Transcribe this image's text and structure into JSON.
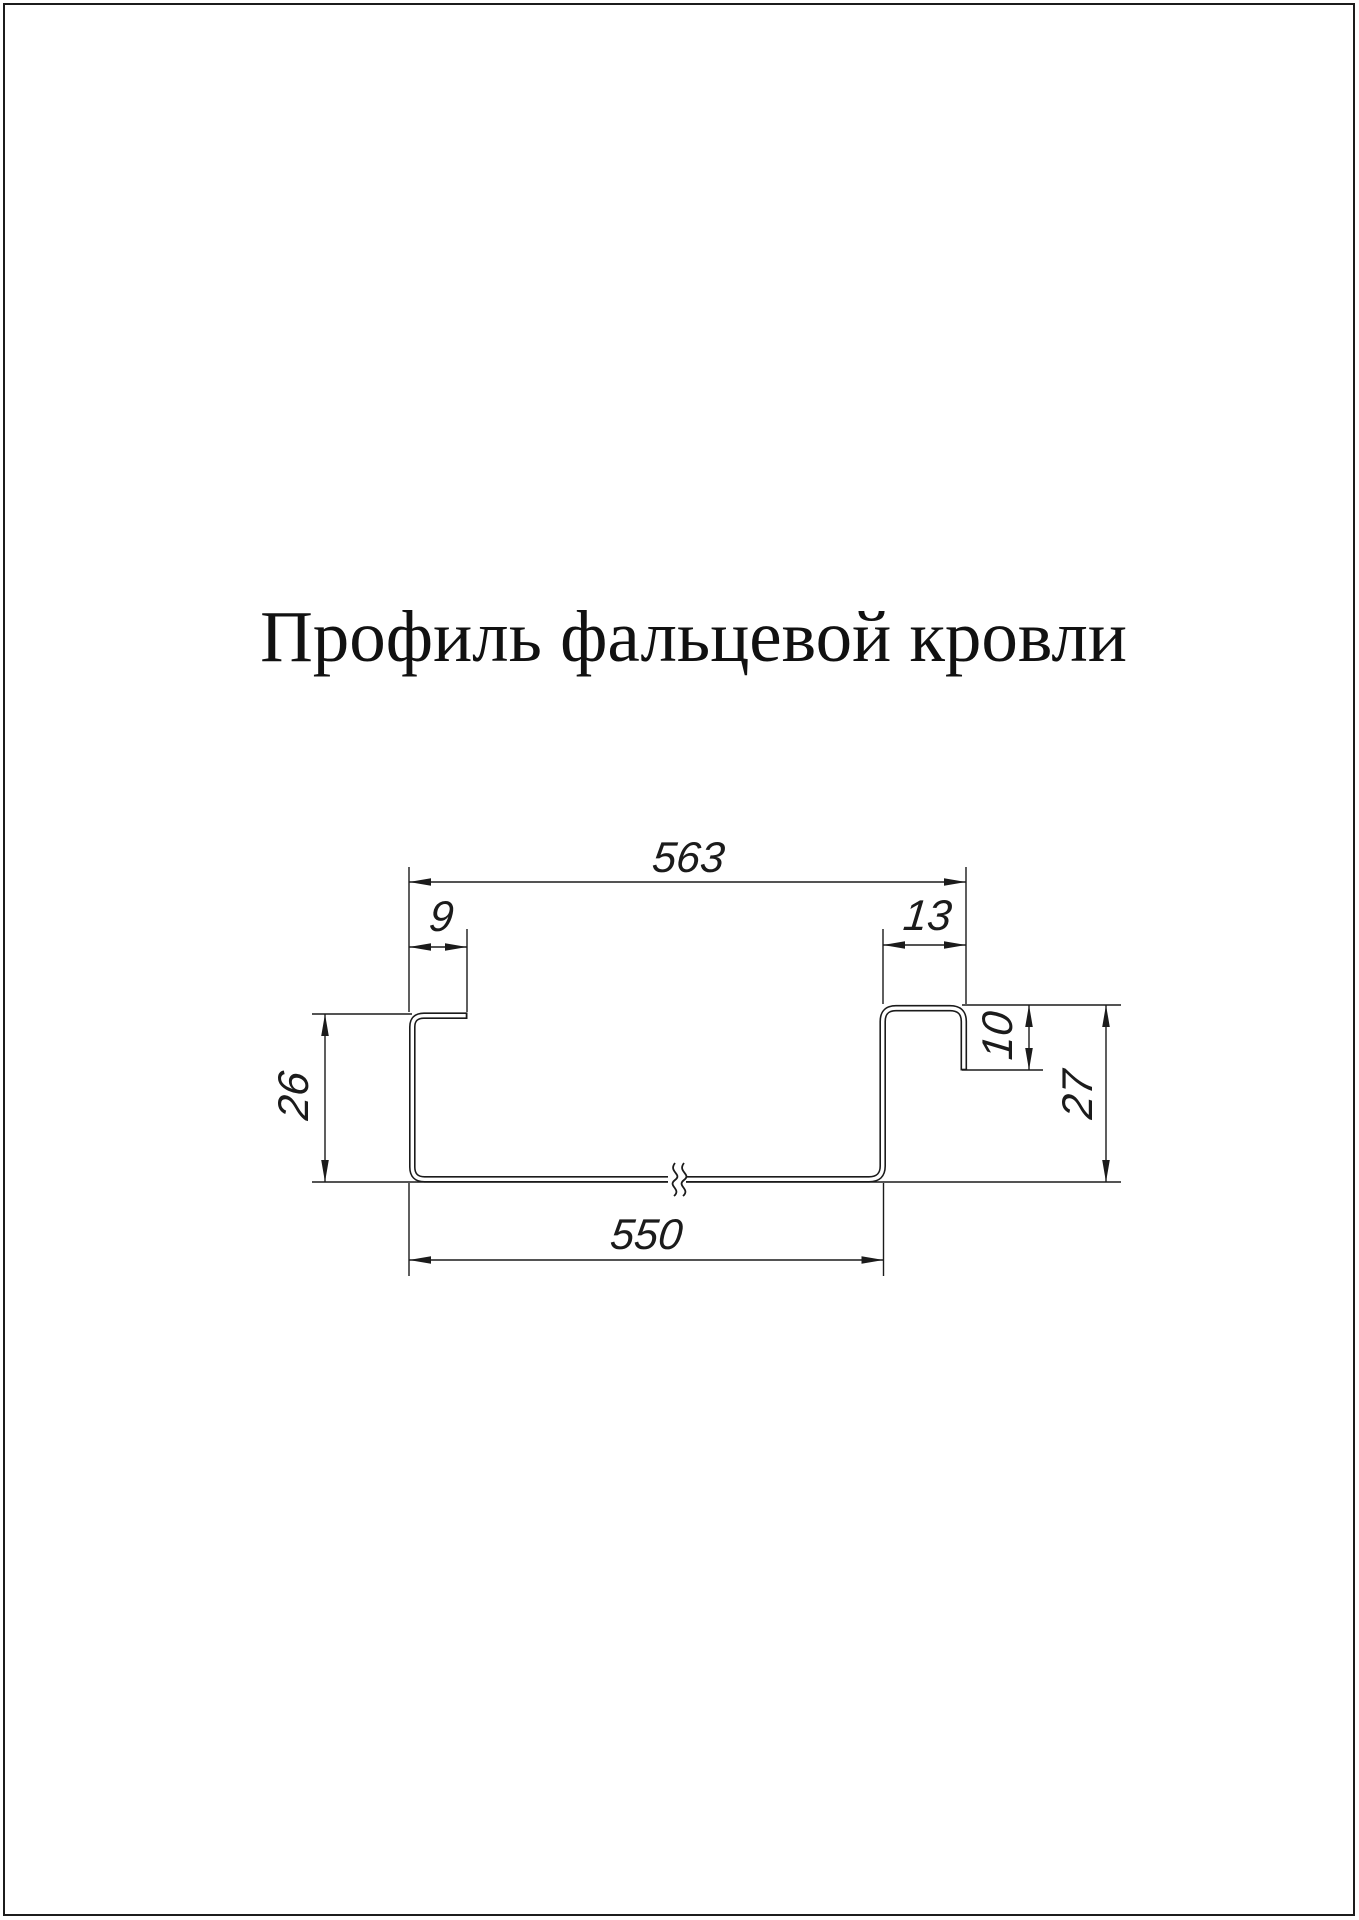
{
  "title": "Профиль фальцевой кровли",
  "drawing": {
    "type": "technical-profile-cross-section",
    "line_color": "#1b1b1b",
    "labels": {
      "overall_top": "563",
      "flange_left": "9",
      "seam_width": "13",
      "height_left": "26",
      "seam_height": "10",
      "height_right": "27",
      "bottom_width": "550"
    }
  }
}
